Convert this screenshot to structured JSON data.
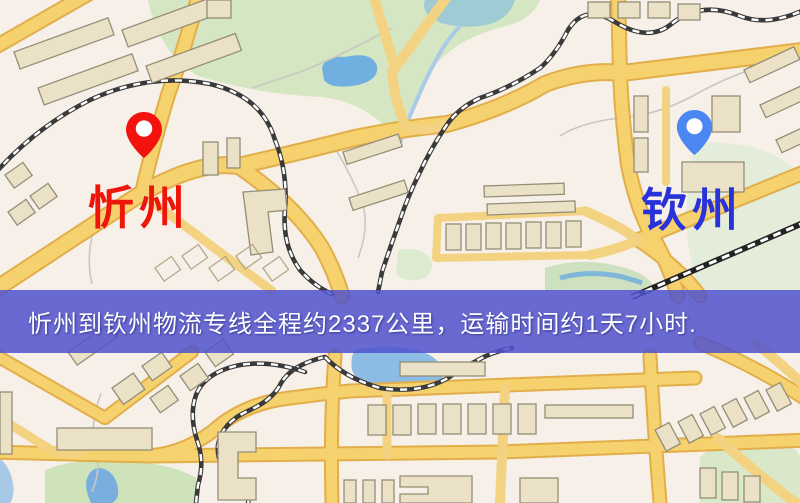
{
  "map": {
    "banner": {
      "text": "忻州到钦州物流专线全程约2337公里，运输时间约1天7小时.",
      "bg_color": "rgba(79,82,206,0.85)",
      "text_color": "#ffffff"
    },
    "origin": {
      "label": "忻州",
      "pin_color": "#f3130e",
      "label_color": "#ee1509"
    },
    "destination": {
      "label": "钦州",
      "pin_color": "#4a87f2",
      "label_color": "#2832d9"
    },
    "route": {
      "origin_city": "忻州",
      "destination_city": "钦州",
      "distance_km": "2337",
      "duration": "1天7小时"
    }
  }
}
